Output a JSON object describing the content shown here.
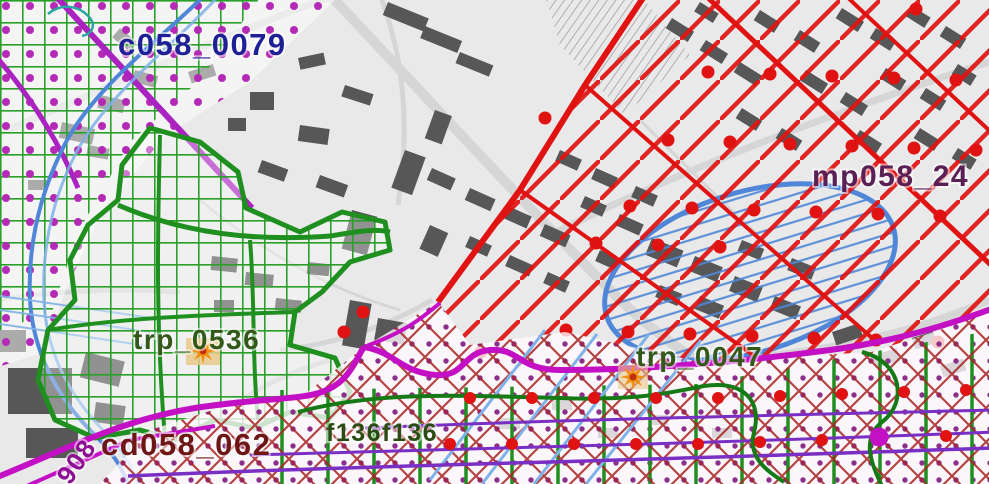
{
  "labels": {
    "c058_0079": {
      "text": "c058_0079"
    },
    "mp058_24": {
      "text": "mp058_24"
    },
    "trp_0536": {
      "text": "trp_0536"
    },
    "trp_0047": {
      "text": "trp_0047"
    },
    "cd058_062": {
      "text": "cd058_062"
    },
    "f136f136": {
      "text": "f136f136"
    },
    "rotated_908": {
      "text": "908"
    }
  },
  "colors": {
    "label_blue": "#1f1f96",
    "label_purple": "#5a2055",
    "label_green": "#33591a",
    "label_maroon": "#6e1616",
    "label_darkgreen": "#2a4c12",
    "label_magenta": "#8d1092",
    "red": "#e01212",
    "red_dark": "#a82424",
    "green_border": "#1f9020",
    "green_line": "#2aa02a",
    "green_dark": "#157a15",
    "magenta": "#c410c4",
    "magenta_dot": "#b52ab5",
    "magenta_dot_small": "#8b2f8b",
    "purple": "#7a2fc4",
    "violet_line": "#aa22c0",
    "blue": "#4f86d8",
    "blue_light": "#7fb2e8",
    "teal": "#2aa7a0",
    "orange": "#f09010",
    "orange_core": "#c03010",
    "tan": "#e8c98a",
    "base_bg": "#e9e9e9",
    "building": "#575757",
    "road": "#d6d6d6"
  }
}
